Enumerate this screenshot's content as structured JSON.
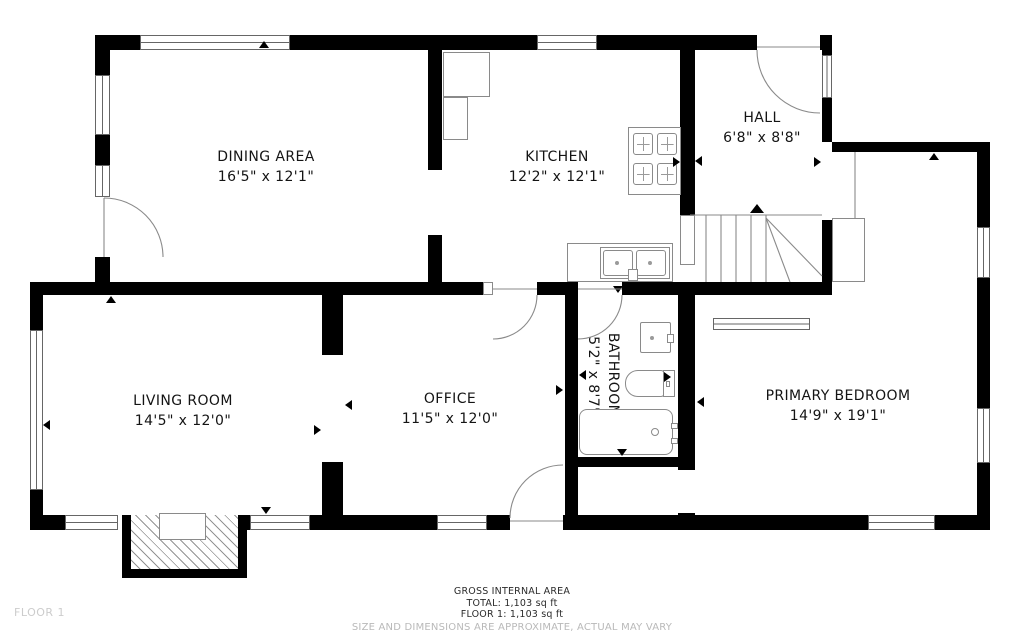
{
  "floor_label": "FLOOR 1",
  "rooms": [
    {
      "id": "dining",
      "name": "DINING AREA",
      "dimensions": "16'5\" x 12'1\""
    },
    {
      "id": "kitchen",
      "name": "KITCHEN",
      "dimensions": "12'2\" x 12'1\""
    },
    {
      "id": "hall",
      "name": "HALL",
      "dimensions": "6'8\" x 8'8\""
    },
    {
      "id": "living",
      "name": "LIVING ROOM",
      "dimensions": "14'5\" x 12'0\""
    },
    {
      "id": "office",
      "name": "OFFICE",
      "dimensions": "11'5\" x 12'0\""
    },
    {
      "id": "bathroom",
      "name": "BATHROOM",
      "dimensions": "5'2\" x 8'7\""
    },
    {
      "id": "primary_bedroom",
      "name": "PRIMARY BEDROOM",
      "dimensions": "14'9\" x 19'1\""
    }
  ],
  "footer": {
    "line1": "GROSS INTERNAL AREA",
    "line2": "TOTAL: 1,103 sq ft",
    "line3": "FLOOR 1: 1,103 sq ft",
    "disclaimer": "SIZE AND DIMENSIONS ARE APPROXIMATE, ACTUAL MAY VARY"
  },
  "fixtures": [
    "stove",
    "kitchen-sink",
    "refrigerator-cabinet",
    "bathroom-sink",
    "toilet",
    "bathtub",
    "fireplace",
    "stairs",
    "closet"
  ],
  "colors": {
    "wall": "#000000",
    "line": "#8a8a8a",
    "label": "#141414",
    "muted": "#b9b9b9"
  }
}
